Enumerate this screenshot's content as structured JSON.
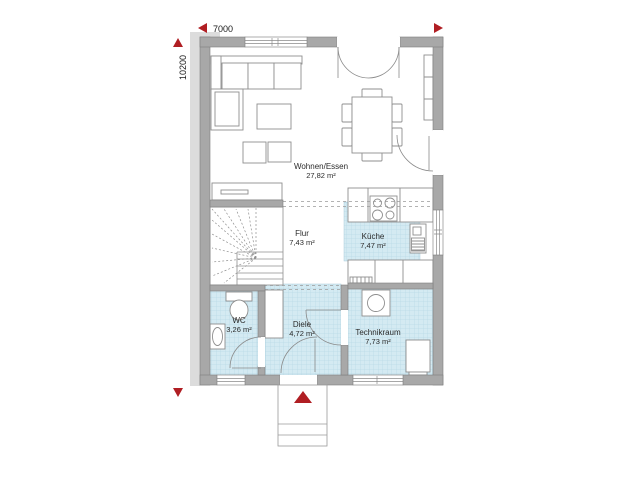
{
  "dimensions": {
    "width_label": "7000",
    "height_label": "10200"
  },
  "rooms": [
    {
      "name": "Wohnen/Essen",
      "area": "27,82 m²"
    },
    {
      "name": "Flur",
      "area": "7,43 m²"
    },
    {
      "name": "Küche",
      "area": "7,47 m²"
    },
    {
      "name": "WC",
      "area": "3,26 m²"
    },
    {
      "name": "Diele",
      "area": "4,72 m²"
    },
    {
      "name": "Technikraum",
      "area": "7,73 m²"
    }
  ],
  "colors": {
    "wall": "#a8a8a8",
    "wall_edge": "#7e7e7e",
    "floor_tint": "#d4eaf2",
    "floor_grid": "#b9d9e6",
    "accent_red": "#b01e23",
    "furniture_line": "#8f8f8f",
    "shadow": "#dcdcdc"
  }
}
